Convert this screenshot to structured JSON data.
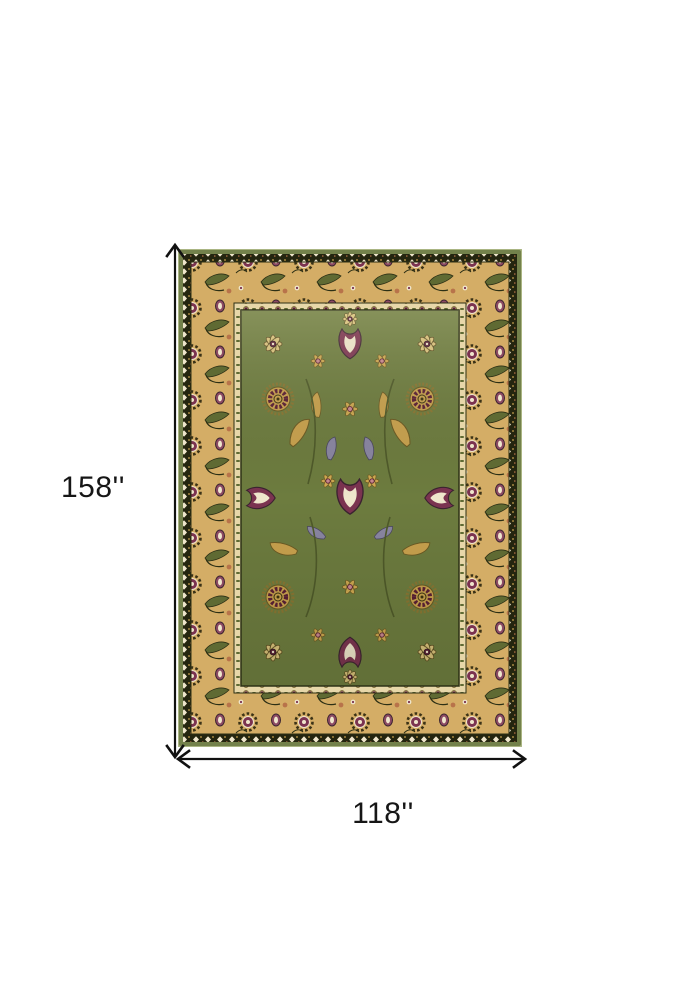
{
  "figure": {
    "type": "product-dimension-image",
    "background": "#ffffff",
    "height_label": "158''",
    "width_label": "118''",
    "arrow_color": "#111111"
  },
  "rug": {
    "description": "Green and tan traditional oriental area rug with floral Kashan pattern",
    "palette": {
      "outer_edge_green": "#73814b",
      "guard_dark": "#24250f",
      "border_tan": "#d4ad66",
      "inner_guard_cream": "#e7d7a9",
      "field_green": "#6d7c3f",
      "flower_gold": "#c9a24e",
      "flower_plum": "#5a1f35",
      "accent_cream": "#efe6cc",
      "accent_rust": "#b8734a",
      "accent_blue_grey": "#8a86a2"
    }
  }
}
